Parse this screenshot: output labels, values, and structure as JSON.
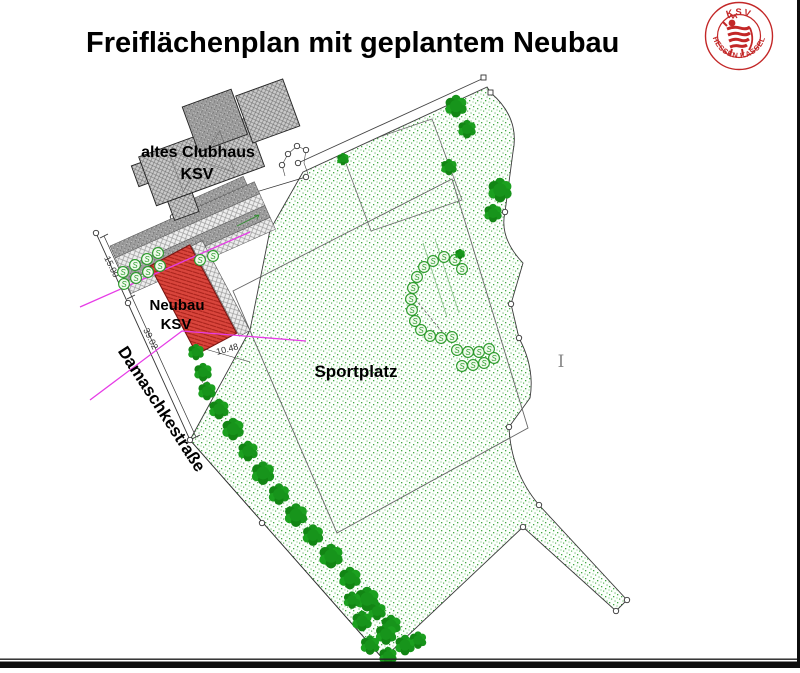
{
  "title": "Freiflächenplan mit geplantem Neubau",
  "logo": {
    "top": "KSV",
    "bottom": "HESSEN  KASSEL",
    "color": "#c32727"
  },
  "labels": {
    "old_clubhouse": "altes Clubhaus",
    "old_clubhouse_sub": "KSV",
    "new_building": "Neubau",
    "new_building_sub": "KSV",
    "sports_field": "Sportplatz",
    "street": "Damaschkestraße",
    "cursor": "I"
  },
  "dimensions": {
    "street_width": "15.00",
    "building_side": "39.02",
    "front": "10.48",
    "small": "3.18"
  },
  "colors": {
    "new_building_red": "#d9453c",
    "new_building_hatch": "#a62019",
    "green_dots": "#44a944",
    "tree_green": "#17941b",
    "magenta_boundary": "#e63ce6",
    "old_building_gray": "#c9c9c9",
    "border_black": "#111111"
  }
}
